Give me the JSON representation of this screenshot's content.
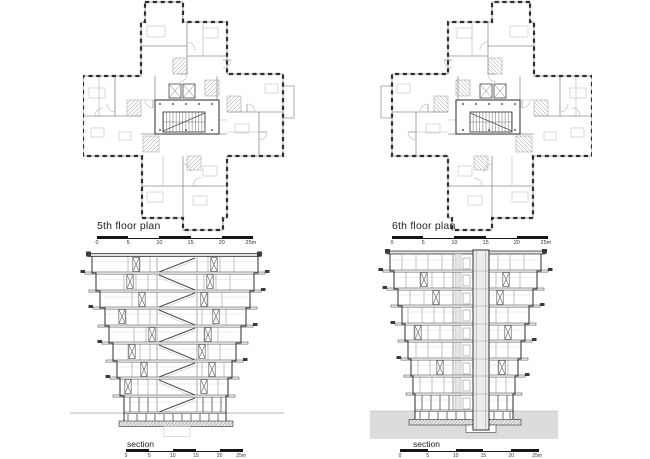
{
  "sheet": {
    "plans": [
      {
        "label": "5th floor plan"
      },
      {
        "label": "6th floor plan"
      }
    ],
    "sections": [
      {
        "label": "section"
      },
      {
        "label": "section"
      }
    ],
    "scale_labels": [
      "0",
      "5",
      "10",
      "15",
      "20",
      "25m"
    ]
  },
  "colors": {
    "ink": "#2e2e2e",
    "wall_mid": "#555555",
    "line_light": "#9a9a9a",
    "terrain": "#dcdcdc",
    "scalebar": "#161616"
  }
}
